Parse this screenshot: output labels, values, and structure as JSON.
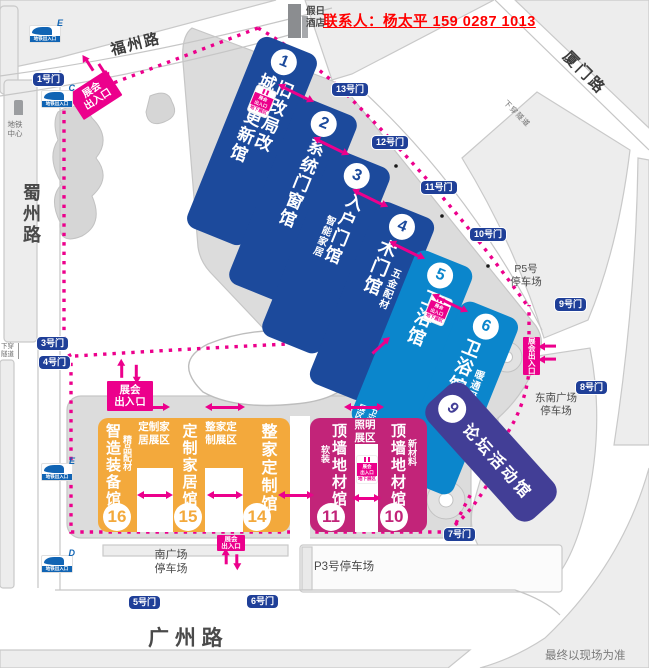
{
  "contact": {
    "text": "联系人：杨太平 159 0287 1013"
  },
  "hotel": {
    "line1": "假日",
    "line2": "酒店"
  },
  "roads": {
    "fuzhou": "福州路",
    "xiamen": "厦门路",
    "shuzhou": "蜀州路",
    "guangzhou": "广  州  路",
    "underpass": "下穿隧道",
    "metro_center_line1": "地铁",
    "metro_center_line2": "中心"
  },
  "metro": {
    "entrance_label": "地铁出入口",
    "letters": [
      "E",
      "C",
      "E",
      "D"
    ]
  },
  "gates": {
    "g1": "1号门",
    "g3": "3号门",
    "g4": "4号门",
    "g5": "5号门",
    "g6": "6号门",
    "g7": "7号门",
    "g8": "8号门",
    "g9": "9号门",
    "g10": "10号门",
    "g11": "11号门",
    "g12": "12号门",
    "g13": "13号门"
  },
  "entrance": {
    "line1": "展会",
    "line2": "出入口",
    "joined": "展会出入口",
    "underground": "地下展区"
  },
  "halls": {
    "h1": {
      "no": "1",
      "line1": "旧改局改",
      "line2": "城市更新馆"
    },
    "h2": {
      "no": "2",
      "name": "系统门窗馆"
    },
    "h3": {
      "no": "3",
      "name": "入户门馆",
      "sub": "智能家居"
    },
    "h4": {
      "no": "4",
      "name": "木门馆",
      "sub": "五金配材"
    },
    "h5": {
      "no": "5",
      "name": "卫浴馆",
      "corner1": "卫浴",
      "corner2": "展区"
    },
    "h6": {
      "no": "6",
      "name": "卫浴馆",
      "sub": "暖通厨电"
    },
    "h9": {
      "no": "9",
      "name": "论坛活动馆"
    },
    "h10": {
      "no": "10",
      "name": "顶墙地材馆",
      "sub": "新材料"
    },
    "h11": {
      "no": "11",
      "name": "顶墙地材馆",
      "sub": "软装"
    },
    "h14": {
      "no": "14",
      "name": "整家定制馆"
    },
    "h15": {
      "no": "15",
      "name": "定制家居馆"
    },
    "h16": {
      "no": "16",
      "name": "智造装备馆",
      "sub": "精品配材"
    }
  },
  "zones": {
    "custom_home": "定制家居展区",
    "whole_home": "整家定制展区",
    "lighting": "照明展区"
  },
  "parking": {
    "p5_line1": "P5号",
    "p5_line2": "停车场",
    "p3": "P3号停车场",
    "south_line1": "南广场",
    "south_line2": "停车场",
    "se_line1": "东南广场",
    "se_line2": "停车场"
  },
  "footer": {
    "note": "最终以现场为准"
  },
  "colors": {
    "accent_pink": "#ec008c",
    "hall_blue_dark": "#1c4a9c",
    "hall_blue_light": "#0b86cc",
    "hall_purple": "#423e96",
    "hall_orange": "#f3a93c",
    "hall_magenta": "#c22479",
    "gate_navy": "#1f3f98",
    "contact_red": "#ff0000"
  }
}
